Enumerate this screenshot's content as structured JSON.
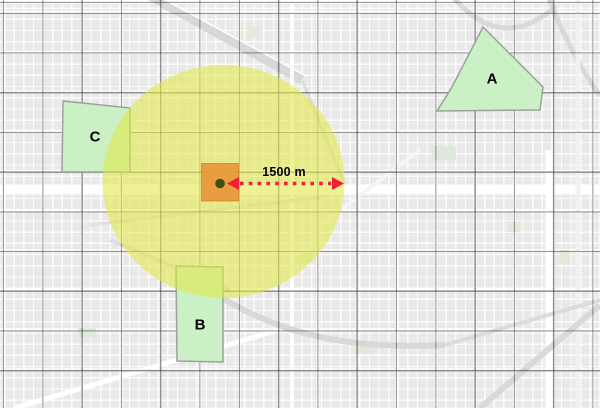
{
  "scale": {
    "label": "1500 m"
  },
  "zones": [
    {
      "label": "A"
    },
    {
      "label": "B"
    },
    {
      "label": "C"
    }
  ],
  "colors": {
    "buffer_fill": "rgba(226,232,72,0.58)",
    "zone_fill": "#cbf0c5",
    "zone_stroke": "#9aa39a",
    "cell_fill": "rgba(232,150,58,0.92)",
    "cell_stroke": "rgba(186,108,28,0.55)",
    "center_point": "#3d4e0f",
    "arrow": "#ee2136",
    "label_color": "#000000"
  }
}
